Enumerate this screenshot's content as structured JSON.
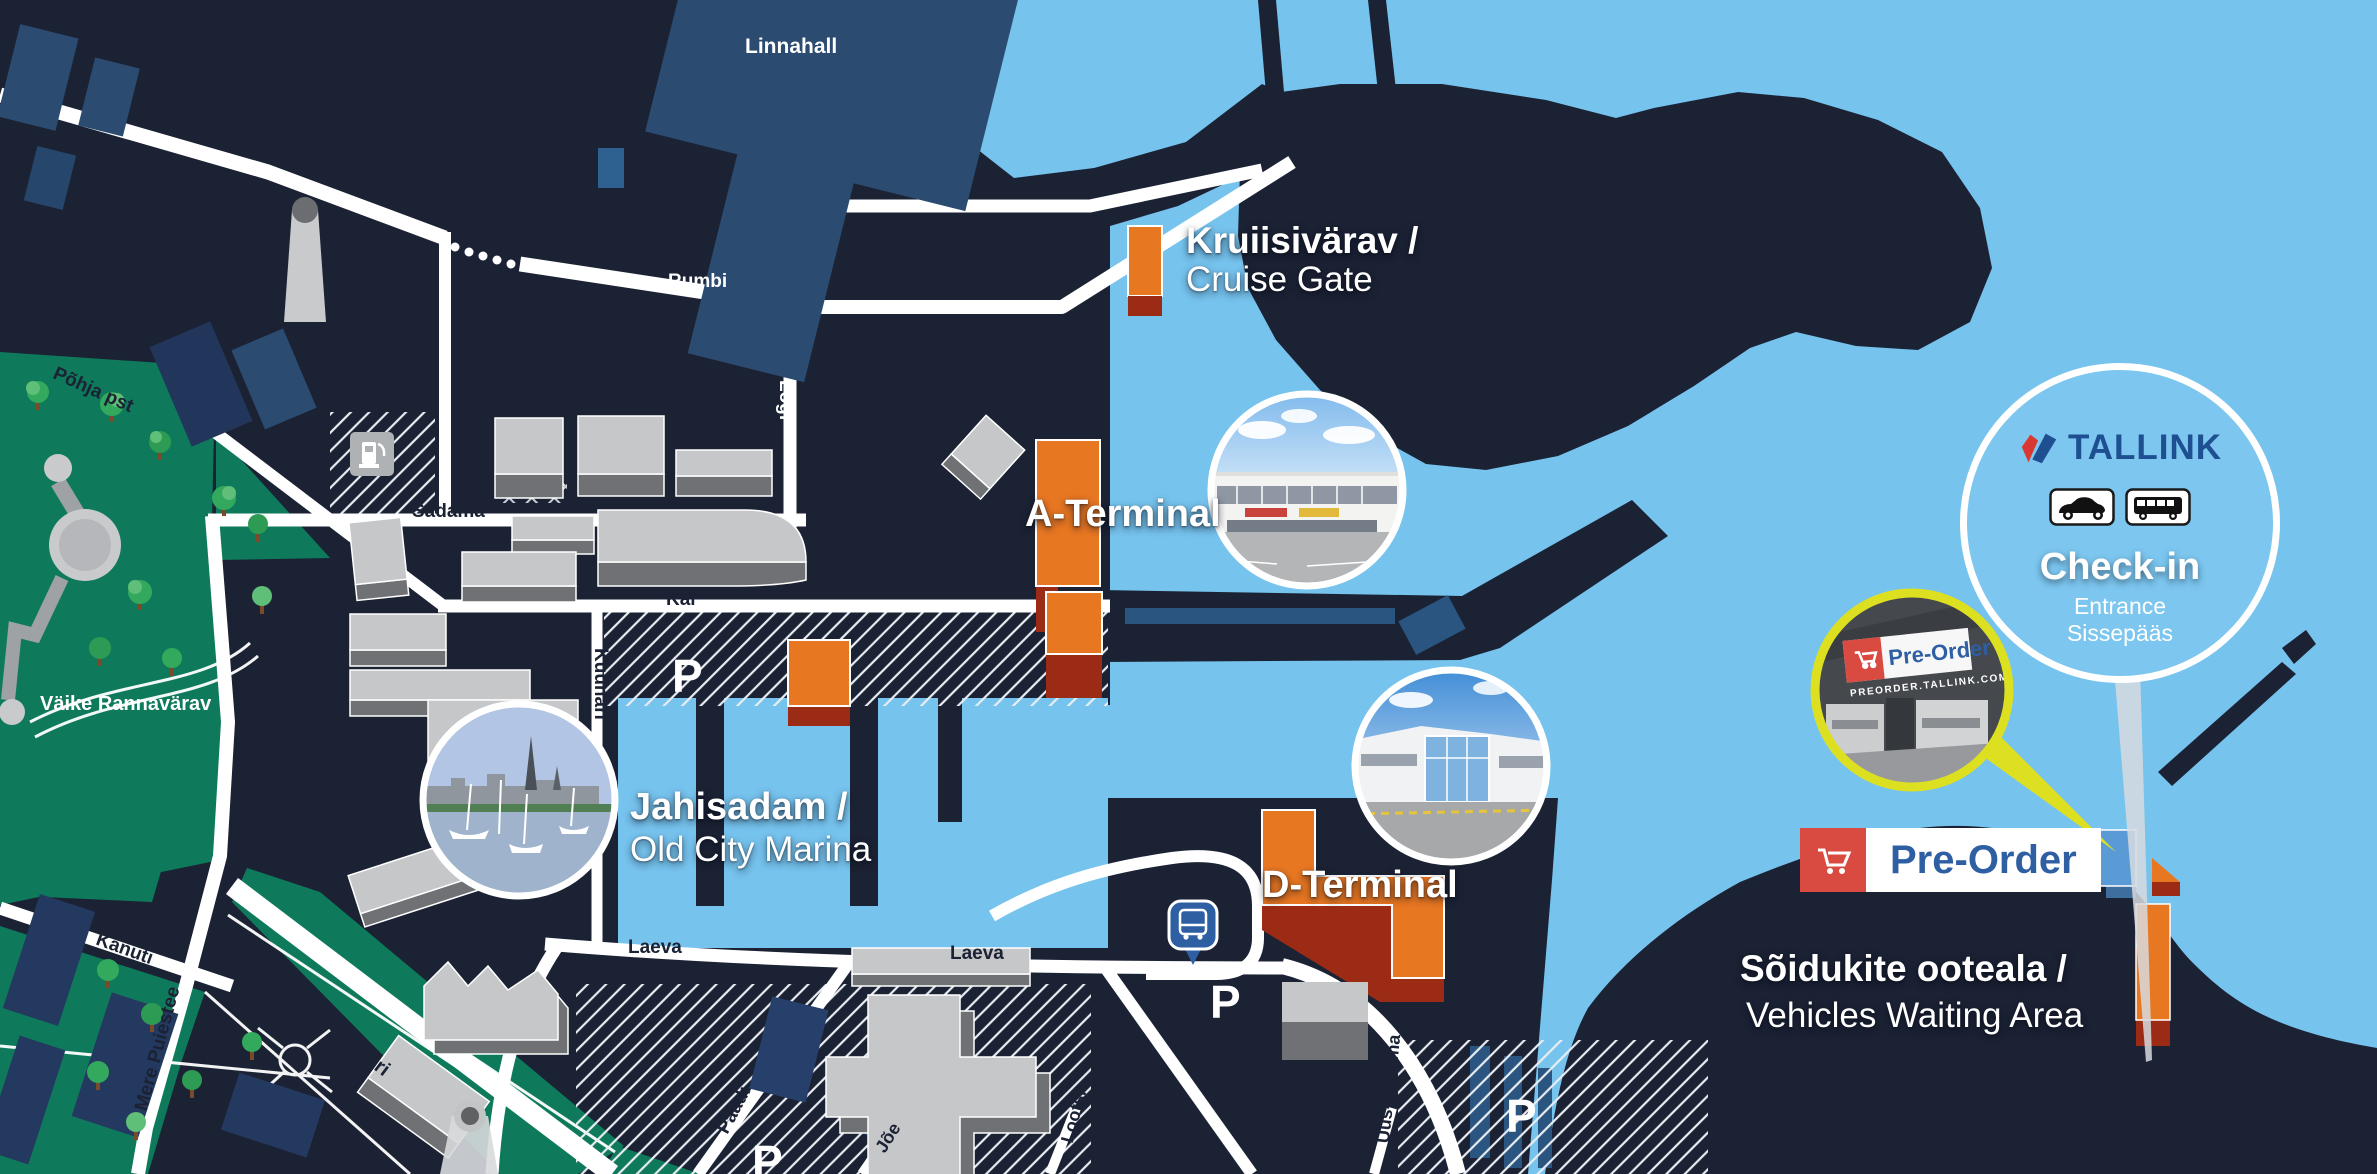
{
  "canvas": {
    "width": 2377,
    "height": 1174
  },
  "palette": {
    "land": "#1B2234",
    "water": "#76C3EE",
    "navy_building": "#2B4B70",
    "pier_accent": "#2A5580",
    "building_light": "#C6C7C9",
    "building_shadow": "#6F7174",
    "green": "#0E7A5B",
    "tree": "#33A95D",
    "terminal_orange": "#E87722",
    "terminal_base_red": "#9B2B15",
    "blue_building": "#5B9BD5",
    "road": "#FFFFFF",
    "accent_yellow": "#DDE021",
    "tallink_blue": "#1D4F91",
    "tallink_red": "#D93832",
    "preorder_red": "#D94A41",
    "pin_blue": "#2E5FA3"
  },
  "places": {
    "linnahall": "Linnahall",
    "cruise_gate": {
      "et": "Kruiisivärav /",
      "en": "Cruise Gate"
    },
    "a_terminal": "A-Terminal",
    "d_terminal": "D-Terminal",
    "marina": {
      "et": "Jahisadam /",
      "en": "Old City Marina"
    },
    "waiting_area": {
      "et": "Sõidukite ooteala /",
      "en": "Vehicles Waiting Area"
    },
    "vaike_rannavarav": "Väike Rannavärav",
    "checkin": {
      "brand": "TALLINK",
      "title": "Check-in",
      "entrance": "Entrance",
      "sissepaas": "Sissepääs"
    },
    "preorder": {
      "label": "Pre-Order",
      "sign": "Pre-Order",
      "url": "PREORDER.TALLINK.COM"
    },
    "parking": "P"
  },
  "streets": {
    "pohja_pst": "Põhja pst",
    "rumbi": "Rumbi",
    "logi": "Logi",
    "sadama": "Sadama",
    "kai": "Kai",
    "kuunari": "Kuunari",
    "kanuti": "Kanuti",
    "mere_puiestee": "Mere Puiestee",
    "ahtri": "Ahtri",
    "laeva": "Laeva",
    "paadi": "Paadi",
    "joe": "Jõe",
    "lootsi": "Lootsi",
    "uus_sadama": "Uus-Sadama"
  },
  "icons": {
    "cart": "shopping-cart",
    "bus_pin": "bus-stop",
    "car_sign": "car",
    "bus_sign": "bus",
    "fuel": "fuel-pump",
    "tallink_mark": "tallink-double-check",
    "magnifier": "magnifier-callout"
  }
}
